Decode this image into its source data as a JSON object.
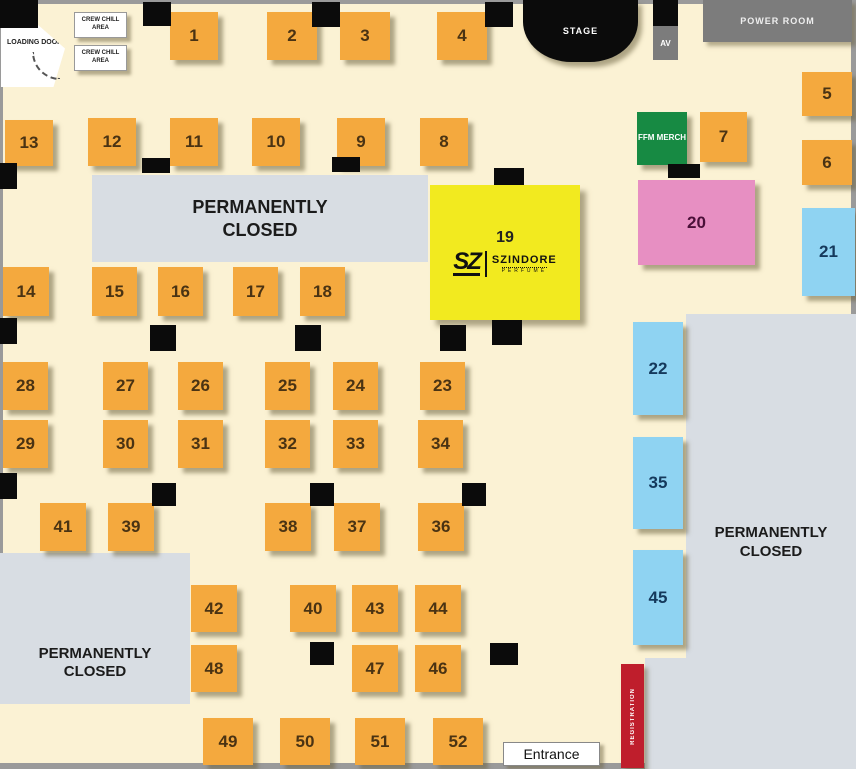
{
  "labels": {
    "loading_door": "LOADING DOOR",
    "crew_chill": "CREW CHILL AREA",
    "stage": "STAGE",
    "av": "AV",
    "power_room": "POWER ROOM",
    "ffm_merch": "FFM MERCH",
    "permanently_closed": "PERMANENTLY CLOSED",
    "registration": "REGISTRATION",
    "entrance": "Entrance"
  },
  "booth19": {
    "number": "19",
    "logo": "SZ",
    "brand": "SZINDORE",
    "brand_sub": "PERFUME"
  },
  "colors": {
    "background": "#FBF2D4",
    "booth_orange": "#F4A93E",
    "booth_blue": "#8FD3F2",
    "booth_pink": "#E78FC2",
    "booth_yellow": "#F2EA1F",
    "merch_green": "#178A43",
    "closed_gray": "#D8DDE3",
    "room_gray": "#7C7C7C",
    "registration_red": "#BF1E2C",
    "stage_black": "#0B0B0B"
  },
  "booths": [
    {
      "n": "1",
      "x": 170,
      "y": 12,
      "w": 48,
      "h": 48,
      "t": "orange"
    },
    {
      "n": "2",
      "x": 267,
      "y": 12,
      "w": 50,
      "h": 48,
      "t": "orange"
    },
    {
      "n": "3",
      "x": 340,
      "y": 12,
      "w": 50,
      "h": 48,
      "t": "orange"
    },
    {
      "n": "4",
      "x": 437,
      "y": 12,
      "w": 50,
      "h": 48,
      "t": "orange"
    },
    {
      "n": "5",
      "x": 802,
      "y": 72,
      "w": 50,
      "h": 44,
      "t": "orange"
    },
    {
      "n": "6",
      "x": 802,
      "y": 140,
      "w": 50,
      "h": 45,
      "t": "orange"
    },
    {
      "n": "13",
      "x": 5,
      "y": 120,
      "w": 48,
      "h": 46,
      "t": "orange"
    },
    {
      "n": "12",
      "x": 88,
      "y": 118,
      "w": 48,
      "h": 48,
      "t": "orange"
    },
    {
      "n": "11",
      "x": 170,
      "y": 118,
      "w": 48,
      "h": 48,
      "t": "orange"
    },
    {
      "n": "10",
      "x": 252,
      "y": 118,
      "w": 48,
      "h": 48,
      "t": "orange"
    },
    {
      "n": "9",
      "x": 337,
      "y": 118,
      "w": 48,
      "h": 48,
      "t": "orange"
    },
    {
      "n": "8",
      "x": 420,
      "y": 118,
      "w": 48,
      "h": 48,
      "t": "orange"
    },
    {
      "n": "7",
      "x": 700,
      "y": 112,
      "w": 47,
      "h": 50,
      "t": "orange"
    },
    {
      "n": "20",
      "x": 638,
      "y": 180,
      "w": 117,
      "h": 85,
      "t": "pink"
    },
    {
      "n": "21",
      "x": 802,
      "y": 208,
      "w": 53,
      "h": 88,
      "t": "blue"
    },
    {
      "n": "14",
      "x": 3,
      "y": 267,
      "w": 46,
      "h": 49,
      "t": "orange"
    },
    {
      "n": "15",
      "x": 92,
      "y": 267,
      "w": 45,
      "h": 49,
      "t": "orange"
    },
    {
      "n": "16",
      "x": 158,
      "y": 267,
      "w": 45,
      "h": 49,
      "t": "orange"
    },
    {
      "n": "17",
      "x": 233,
      "y": 267,
      "w": 45,
      "h": 49,
      "t": "orange"
    },
    {
      "n": "18",
      "x": 300,
      "y": 267,
      "w": 45,
      "h": 49,
      "t": "orange"
    },
    {
      "n": "28",
      "x": 3,
      "y": 362,
      "w": 45,
      "h": 48,
      "t": "orange"
    },
    {
      "n": "27",
      "x": 103,
      "y": 362,
      "w": 45,
      "h": 48,
      "t": "orange"
    },
    {
      "n": "26",
      "x": 178,
      "y": 362,
      "w": 45,
      "h": 48,
      "t": "orange"
    },
    {
      "n": "25",
      "x": 265,
      "y": 362,
      "w": 45,
      "h": 48,
      "t": "orange"
    },
    {
      "n": "24",
      "x": 333,
      "y": 362,
      "w": 45,
      "h": 48,
      "t": "orange"
    },
    {
      "n": "23",
      "x": 420,
      "y": 362,
      "w": 45,
      "h": 48,
      "t": "orange"
    },
    {
      "n": "29",
      "x": 3,
      "y": 420,
      "w": 45,
      "h": 48,
      "t": "orange"
    },
    {
      "n": "30",
      "x": 103,
      "y": 420,
      "w": 45,
      "h": 48,
      "t": "orange"
    },
    {
      "n": "31",
      "x": 178,
      "y": 420,
      "w": 45,
      "h": 48,
      "t": "orange"
    },
    {
      "n": "32",
      "x": 265,
      "y": 420,
      "w": 45,
      "h": 48,
      "t": "orange"
    },
    {
      "n": "33",
      "x": 333,
      "y": 420,
      "w": 45,
      "h": 48,
      "t": "orange"
    },
    {
      "n": "34",
      "x": 418,
      "y": 420,
      "w": 45,
      "h": 48,
      "t": "orange"
    },
    {
      "n": "22",
      "x": 633,
      "y": 322,
      "w": 50,
      "h": 93,
      "t": "blue"
    },
    {
      "n": "35",
      "x": 633,
      "y": 437,
      "w": 50,
      "h": 92,
      "t": "blue"
    },
    {
      "n": "45",
      "x": 633,
      "y": 550,
      "w": 50,
      "h": 95,
      "t": "blue"
    },
    {
      "n": "41",
      "x": 40,
      "y": 503,
      "w": 46,
      "h": 48,
      "t": "orange"
    },
    {
      "n": "39",
      "x": 108,
      "y": 503,
      "w": 46,
      "h": 48,
      "t": "orange"
    },
    {
      "n": "38",
      "x": 265,
      "y": 503,
      "w": 46,
      "h": 48,
      "t": "orange"
    },
    {
      "n": "37",
      "x": 334,
      "y": 503,
      "w": 46,
      "h": 48,
      "t": "orange"
    },
    {
      "n": "36",
      "x": 418,
      "y": 503,
      "w": 46,
      "h": 48,
      "t": "orange"
    },
    {
      "n": "42",
      "x": 191,
      "y": 585,
      "w": 46,
      "h": 47,
      "t": "orange"
    },
    {
      "n": "40",
      "x": 290,
      "y": 585,
      "w": 46,
      "h": 47,
      "t": "orange"
    },
    {
      "n": "43",
      "x": 352,
      "y": 585,
      "w": 46,
      "h": 47,
      "t": "orange"
    },
    {
      "n": "44",
      "x": 415,
      "y": 585,
      "w": 46,
      "h": 47,
      "t": "orange"
    },
    {
      "n": "48",
      "x": 191,
      "y": 645,
      "w": 46,
      "h": 47,
      "t": "orange"
    },
    {
      "n": "47",
      "x": 352,
      "y": 645,
      "w": 46,
      "h": 47,
      "t": "orange"
    },
    {
      "n": "46",
      "x": 415,
      "y": 645,
      "w": 46,
      "h": 47,
      "t": "orange"
    },
    {
      "n": "49",
      "x": 203,
      "y": 718,
      "w": 50,
      "h": 47,
      "t": "orange"
    },
    {
      "n": "50",
      "x": 280,
      "y": 718,
      "w": 50,
      "h": 47,
      "t": "orange"
    },
    {
      "n": "51",
      "x": 355,
      "y": 718,
      "w": 50,
      "h": 47,
      "t": "orange"
    },
    {
      "n": "52",
      "x": 433,
      "y": 718,
      "w": 50,
      "h": 47,
      "t": "orange"
    }
  ],
  "pillars": [
    [
      0,
      0,
      38,
      28
    ],
    [
      143,
      2,
      28,
      24
    ],
    [
      312,
      2,
      28,
      25
    ],
    [
      485,
      2,
      28,
      25
    ],
    [
      0,
      163,
      17,
      26
    ],
    [
      142,
      158,
      28,
      15
    ],
    [
      332,
      157,
      28,
      15
    ],
    [
      494,
      168,
      30,
      17
    ],
    [
      668,
      164,
      32,
      14
    ],
    [
      0,
      318,
      17,
      26
    ],
    [
      150,
      325,
      26,
      26
    ],
    [
      295,
      325,
      26,
      26
    ],
    [
      440,
      325,
      26,
      26
    ],
    [
      492,
      320,
      30,
      25
    ],
    [
      0,
      473,
      17,
      26
    ],
    [
      152,
      483,
      24,
      23
    ],
    [
      310,
      483,
      24,
      23
    ],
    [
      462,
      483,
      24,
      23
    ],
    [
      310,
      642,
      24,
      23
    ],
    [
      490,
      643,
      28,
      22
    ]
  ],
  "walls": [
    [
      0,
      0,
      856,
      4
    ],
    [
      851,
      0,
      5,
      765
    ],
    [
      0,
      763,
      856,
      6
    ],
    [
      0,
      24,
      3,
      530
    ]
  ]
}
